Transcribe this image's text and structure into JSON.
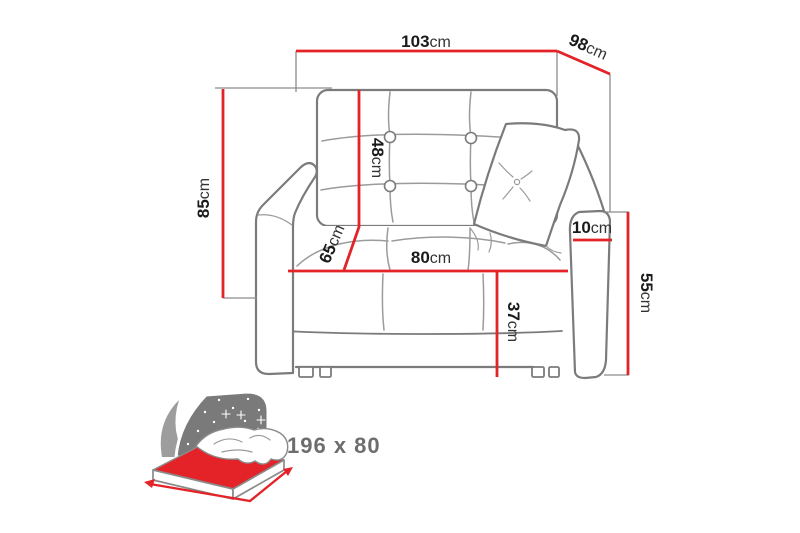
{
  "dimensions": {
    "width": {
      "value": "103",
      "unit": "cm"
    },
    "depth": {
      "value": "98",
      "unit": "cm"
    },
    "height": {
      "value": "85",
      "unit": "cm"
    },
    "backrest": {
      "value": "48",
      "unit": "cm"
    },
    "seat_depth": {
      "value": "65",
      "unit": "cm"
    },
    "seat_width": {
      "value": "80",
      "unit": "cm"
    },
    "armrest_width": {
      "value": "10",
      "unit": "cm"
    },
    "armrest_height": {
      "value": "55",
      "unit": "cm"
    },
    "seat_height": {
      "value": "37",
      "unit": "cm"
    }
  },
  "sleeping_area": {
    "label": "196 x 80"
  },
  "colors": {
    "dimension_red": "#e42329",
    "outline_gray": "#7b7b7b",
    "panel_gray": "#7a7a7a",
    "text_black": "#1a1a1a",
    "label_gray": "#6d6d6d"
  }
}
